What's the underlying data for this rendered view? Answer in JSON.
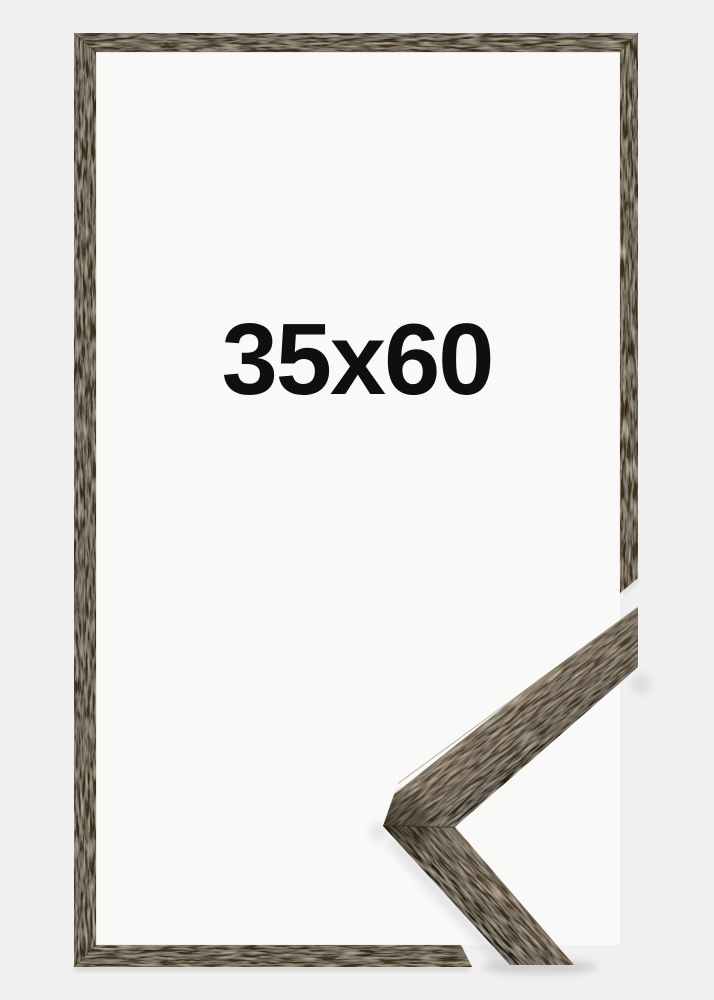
{
  "product": {
    "size_label": "35x60"
  },
  "colors": {
    "background_outer": "#f0f0f1",
    "background_inner": "#f9f9f8",
    "label_text": "#0f0f0f",
    "wood_base": "#4b3c2c",
    "wood_surface_light": "#5b4b39",
    "wood_edge_dark": "#2a2018"
  }
}
